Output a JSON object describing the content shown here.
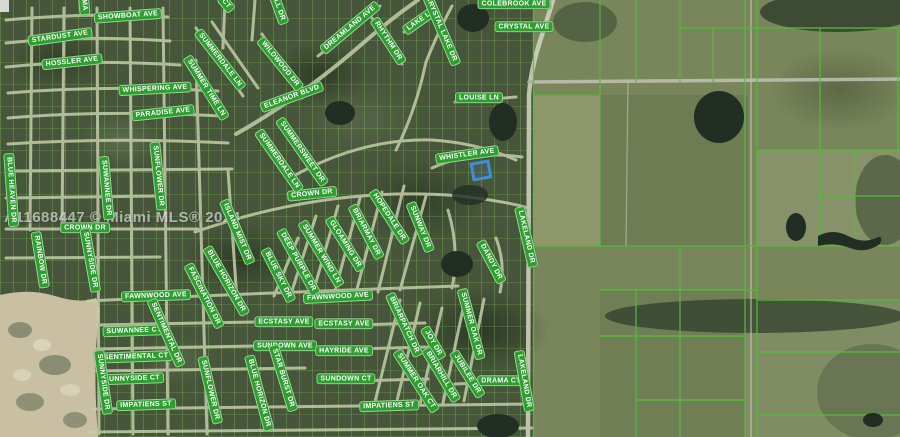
{
  "map": {
    "watermark": "A11688447 © Miami MLS® 2024",
    "colors": {
      "label_bg": "#2f9e31",
      "label_text": "#ffffff",
      "highlight": "#3f8fd6",
      "parcel_line": "#54bd39"
    },
    "highlight_lot": {
      "x": 471,
      "y": 161,
      "w": 14,
      "h": 13,
      "rot": -10
    },
    "street_labels": [
      {
        "t": "SHOWBOAT AVE",
        "x": 128,
        "y": 16,
        "r": -4
      },
      {
        "t": "STARDUST AVE",
        "x": 60,
        "y": 37,
        "r": -8
      },
      {
        "t": "HOSSLER AVE",
        "x": 72,
        "y": 62,
        "r": -6
      },
      {
        "t": "WHISPERING AVE",
        "x": 155,
        "y": 89,
        "r": -3
      },
      {
        "t": "PARADISE AVE",
        "x": 163,
        "y": 113,
        "r": -6
      },
      {
        "t": "COLEBROOK AVE",
        "x": 514,
        "y": 4,
        "r": 0
      },
      {
        "t": "CRYSTAL AVE",
        "x": 524,
        "y": 27,
        "r": 0
      },
      {
        "t": "LOUISE LN",
        "x": 479,
        "y": 98,
        "r": 0
      },
      {
        "t": "WHISTLER AVE",
        "x": 467,
        "y": 155,
        "r": -8
      },
      {
        "t": "ELEANOR BLVD",
        "x": 292,
        "y": 97,
        "r": -20
      },
      {
        "t": "CROWN DR",
        "x": 85,
        "y": 228,
        "r": 0
      },
      {
        "t": "CROWN DR",
        "x": 312,
        "y": 194,
        "r": -6
      },
      {
        "t": "FAWNWOOD AVE",
        "x": 156,
        "y": 296,
        "r": -2
      },
      {
        "t": "FAWNWOOD AVE",
        "x": 338,
        "y": 297,
        "r": -3
      },
      {
        "t": "SUWANNEE CT",
        "x": 134,
        "y": 331,
        "r": -2
      },
      {
        "t": "SENTIMENTAL CT",
        "x": 136,
        "y": 357,
        "r": -2
      },
      {
        "t": "SUNNYSIDE CT",
        "x": 132,
        "y": 379,
        "r": -2
      },
      {
        "t": "IMPATIENS ST",
        "x": 146,
        "y": 405,
        "r": -2
      },
      {
        "t": "IMPATIENS ST",
        "x": 389,
        "y": 406,
        "r": -2
      },
      {
        "t": "ECSTASY AVE",
        "x": 284,
        "y": 322,
        "r": 0
      },
      {
        "t": "ECSTASY AVE",
        "x": 344,
        "y": 324,
        "r": 0
      },
      {
        "t": "SUNDOWN AVE",
        "x": 285,
        "y": 346,
        "r": 0
      },
      {
        "t": "HAYRIDE AVE",
        "x": 344,
        "y": 351,
        "r": 0
      },
      {
        "t": "SUNDOWN CT",
        "x": 346,
        "y": 379,
        "r": 0
      },
      {
        "t": "DRAMA CT",
        "x": 501,
        "y": 381,
        "r": 0
      },
      {
        "t": "SUMMERDALE LN",
        "x": 220,
        "y": 60,
        "r": 52
      },
      {
        "t": "SUMMER TIME LN",
        "x": 206,
        "y": 88,
        "r": 58
      },
      {
        "t": "WILDWOOD DR",
        "x": 280,
        "y": 64,
        "r": 51
      },
      {
        "t": "DREAMLAND AVE",
        "x": 350,
        "y": 28,
        "r": -40
      },
      {
        "t": "RHYTHM DR",
        "x": 388,
        "y": 41,
        "r": 57
      },
      {
        "t": "LAKE LN",
        "x": 421,
        "y": 20,
        "r": -35
      },
      {
        "t": "CRYSTAL LAKE DR",
        "x": 441,
        "y": 29,
        "r": 67
      },
      {
        "t": "SUMMERSWEET DR",
        "x": 302,
        "y": 152,
        "r": 55
      },
      {
        "t": "SUMMERDALE LN",
        "x": 279,
        "y": 161,
        "r": 55
      },
      {
        "t": "BLUE HEAVEN DR",
        "x": 11,
        "y": 190,
        "r": 86
      },
      {
        "t": "SUWANNEE DR",
        "x": 106,
        "y": 188,
        "r": 85
      },
      {
        "t": "SUNFLOWER DR",
        "x": 158,
        "y": 176,
        "r": 84
      },
      {
        "t": "RAINBOW DR",
        "x": 40,
        "y": 260,
        "r": 81
      },
      {
        "t": "SUNNYSIDE DR",
        "x": 90,
        "y": 260,
        "r": 80
      },
      {
        "t": "ISLAND MIST DR",
        "x": 237,
        "y": 232,
        "r": 67
      },
      {
        "t": "FASCINATION DR",
        "x": 204,
        "y": 296,
        "r": 63
      },
      {
        "t": "BLUE HORIZON DR",
        "x": 226,
        "y": 281,
        "r": 60
      },
      {
        "t": "DEEP PURPLE DR",
        "x": 298,
        "y": 262,
        "r": 61
      },
      {
        "t": "BLUE SKY DR",
        "x": 278,
        "y": 275,
        "r": 63
      },
      {
        "t": "SUMMER WIND LN",
        "x": 321,
        "y": 254,
        "r": 59
      },
      {
        "t": "GLOAMING DR",
        "x": 345,
        "y": 244,
        "r": 58
      },
      {
        "t": "BRIARMAY DR",
        "x": 366,
        "y": 232,
        "r": 62
      },
      {
        "t": "HOPEDALE DR",
        "x": 389,
        "y": 217,
        "r": 57
      },
      {
        "t": "SUNWAY DR",
        "x": 420,
        "y": 227,
        "r": 68
      },
      {
        "t": "DANDY DR",
        "x": 491,
        "y": 262,
        "r": 62
      },
      {
        "t": "LAKELAND DR",
        "x": 526,
        "y": 237,
        "r": 77
      },
      {
        "t": "LAKELAND DR",
        "x": 524,
        "y": 381,
        "r": 80
      },
      {
        "t": "SENTIMENTAL DR",
        "x": 166,
        "y": 333,
        "r": 66
      },
      {
        "t": "SUNNYSIDE DR",
        "x": 103,
        "y": 382,
        "r": 82
      },
      {
        "t": "SUNFLOWER DR",
        "x": 210,
        "y": 390,
        "r": 77
      },
      {
        "t": "BLUE HORIZON DR",
        "x": 259,
        "y": 393,
        "r": 75
      },
      {
        "t": "STAR BURST DR",
        "x": 283,
        "y": 378,
        "r": 73
      },
      {
        "t": "BRIARPATCH DR",
        "x": 404,
        "y": 325,
        "r": 65
      },
      {
        "t": "JOY DR",
        "x": 433,
        "y": 343,
        "r": 60
      },
      {
        "t": "SUMMER OAK DR",
        "x": 471,
        "y": 324,
        "r": 75
      },
      {
        "t": "SUMMER OAK CT",
        "x": 416,
        "y": 381,
        "r": 57
      },
      {
        "t": "BRIARHILL DR",
        "x": 441,
        "y": 375,
        "r": 59
      },
      {
        "t": "JUBILEE DR",
        "x": 467,
        "y": 374,
        "r": 58
      },
      {
        "t": "MA",
        "x": 84,
        "y": 5,
        "r": 85
      },
      {
        "t": "CT",
        "x": 226,
        "y": 4,
        "r": 50
      },
      {
        "t": "LL DR",
        "x": 279,
        "y": 10,
        "r": 70
      }
    ]
  }
}
